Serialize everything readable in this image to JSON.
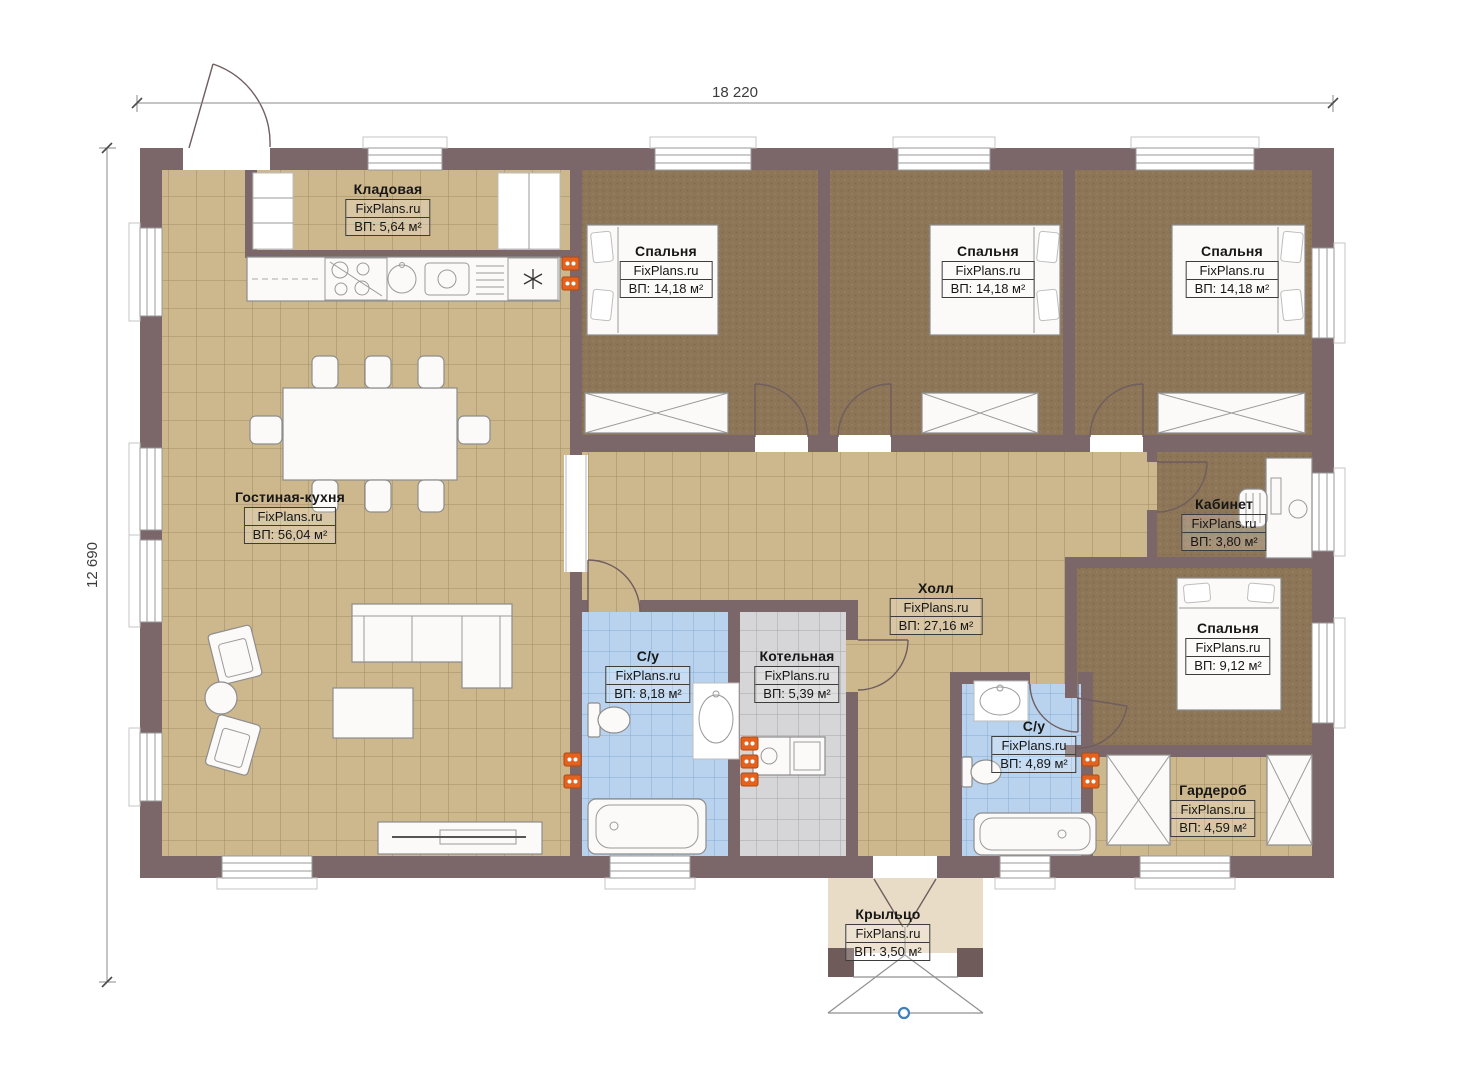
{
  "dimensions": {
    "width": "18 220",
    "height": "12 690"
  },
  "watermark": "FixPlans.ru",
  "rooms": {
    "storage": {
      "name": "Кладовая",
      "site": "FixPlans.ru",
      "area": "ВП: 5,64 м²"
    },
    "bedroom1": {
      "name": "Спальня",
      "site": "FixPlans.ru",
      "area": "ВП: 14,18 м²"
    },
    "bedroom2": {
      "name": "Спальня",
      "site": "FixPlans.ru",
      "area": "ВП: 14,18 м²"
    },
    "bedroom3": {
      "name": "Спальня",
      "site": "FixPlans.ru",
      "area": "ВП: 14,18 м²"
    },
    "living": {
      "name": "Гостиная-кухня",
      "site": "FixPlans.ru",
      "area": "ВП: 56,04 м²"
    },
    "office": {
      "name": "Кабинет",
      "site": "FixPlans.ru",
      "area": "ВП: 3,80 м²"
    },
    "hall": {
      "name": "Холл",
      "site": "FixPlans.ru",
      "area": "ВП: 27,16 м²"
    },
    "bedroom4": {
      "name": "Спальня",
      "site": "FixPlans.ru",
      "area": "ВП: 9,12 м²"
    },
    "bath1": {
      "name": "С/у",
      "site": "FixPlans.ru",
      "area": "ВП: 8,18 м²"
    },
    "boiler": {
      "name": "Котельная",
      "site": "FixPlans.ru",
      "area": "ВП: 5,39 м²"
    },
    "bath2": {
      "name": "С/у",
      "site": "FixPlans.ru",
      "area": "ВП: 4,89 м²"
    },
    "wardrobe": {
      "name": "Гардероб",
      "site": "FixPlans.ru",
      "area": "ВП: 4,59 м²"
    },
    "porch": {
      "name": "Крыльцо",
      "site": "FixPlans.ru",
      "area": "ВП: 3,50 м²"
    }
  },
  "palette": {
    "wall": "#7b6769",
    "tile_beige": "#cdb78c",
    "tile_blue": "#b9d3ef",
    "tile_gray": "#d6d6d8",
    "carpet_brown": "#8d7557",
    "porch_floor": "#e9dcc6",
    "socket_orange": "#e4621f",
    "marker_blue": "#3f7fbe"
  },
  "symbols": {
    "socket_icon": "double-socket",
    "freezer_icon": "snowflake",
    "entry_marker_icon": "blue-dot"
  }
}
